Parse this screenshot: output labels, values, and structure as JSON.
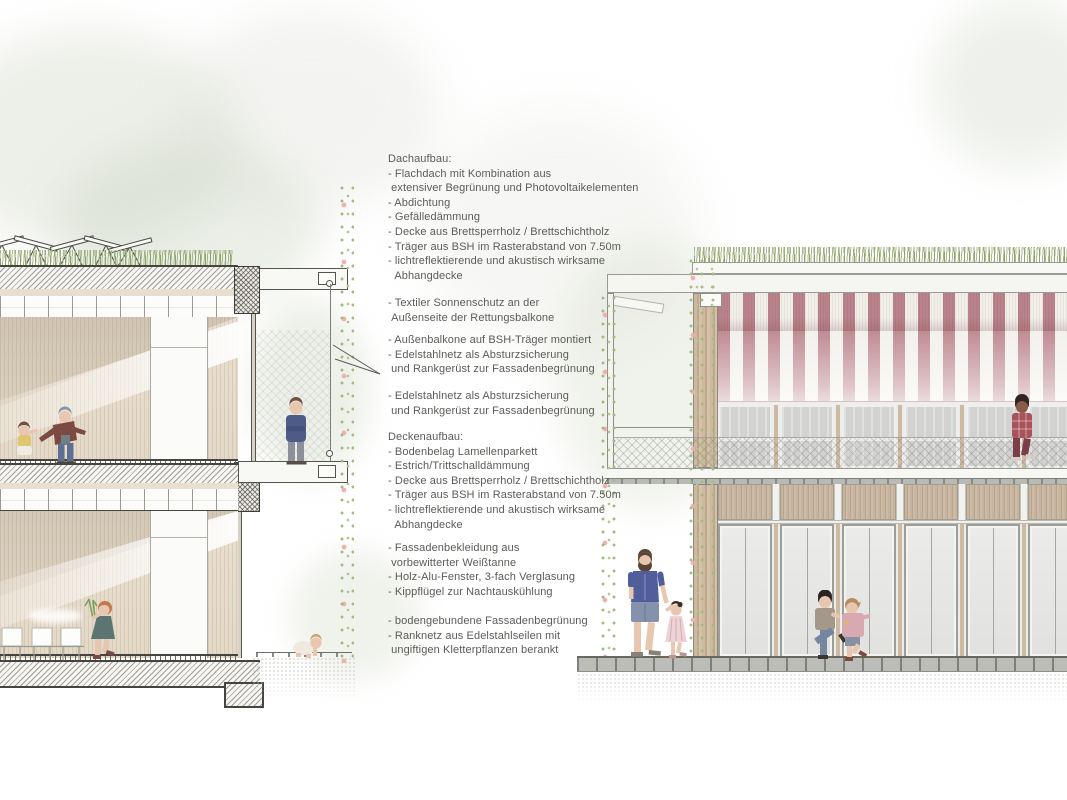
{
  "annotations": {
    "dachaufbau": "Dachaufbau:\n- Flachdach mit Kombination aus\n extensiver Begrünung und Photovoltaikelementen\n- Abdichtung\n- Gefälledämmung\n- Decke aus Brettsperrholz / Brettschichtholz\n- Träger aus BSH im Rasterabstand von 7.50m\n- lichtreflektierende und akustisch wirksame\n  Abhangdecke",
    "sonnenschutz": "- Textiler Sonnenschutz an der\n Außenseite der Rettungsbalkone",
    "aussenbalkone": "- Außenbalkone auf BSH-Träger montiert\n- Edelstahlnetz als Absturzsicherung\n und Rankgerüst zur Fassadenbegrünung",
    "edelstahlnetz": "- Edelstahlnetz als Absturzsicherung\n und Rankgerüst zur Fassadenbegrünung",
    "deckenaufbau": "Deckenaufbau:\n- Bodenbelag Lamellenparkett\n- Estrich/Trittschalldämmung\n- Decke aus Brettsperrholz / Brettschichtholz\n- Träger aus BSH im Rasterabstand von 7.50m\n- lichtreflektierende und akustisch wirksame\n  Abhangdecke",
    "fassade": "- Fassadenbekleidung aus\n vorbewitterter Weißtanne\n- Holz-Alu-Fenster, 3-fach Verglasung\n- Kippflügel zur Nachtauskühlung",
    "begruenung": "- bodengebundene Fassadenbegrünung\n- Ranknetz aus Edelstahlseilen mit\n ungiftigen Kletterpflanzen berankt"
  },
  "colors": {
    "text": "#5b5b57",
    "awning_red": "#ba828a",
    "awning_white": "#f2efe9",
    "wood_light": "#e8ddcd",
    "wood_post": "#cdbaa0",
    "green_roof": "#9aab7e",
    "vine_green": "#a2bb7c",
    "vine_flower": "#f0b0ad",
    "glass_gray": "#d2d3d0",
    "line_dark": "#45443f"
  }
}
